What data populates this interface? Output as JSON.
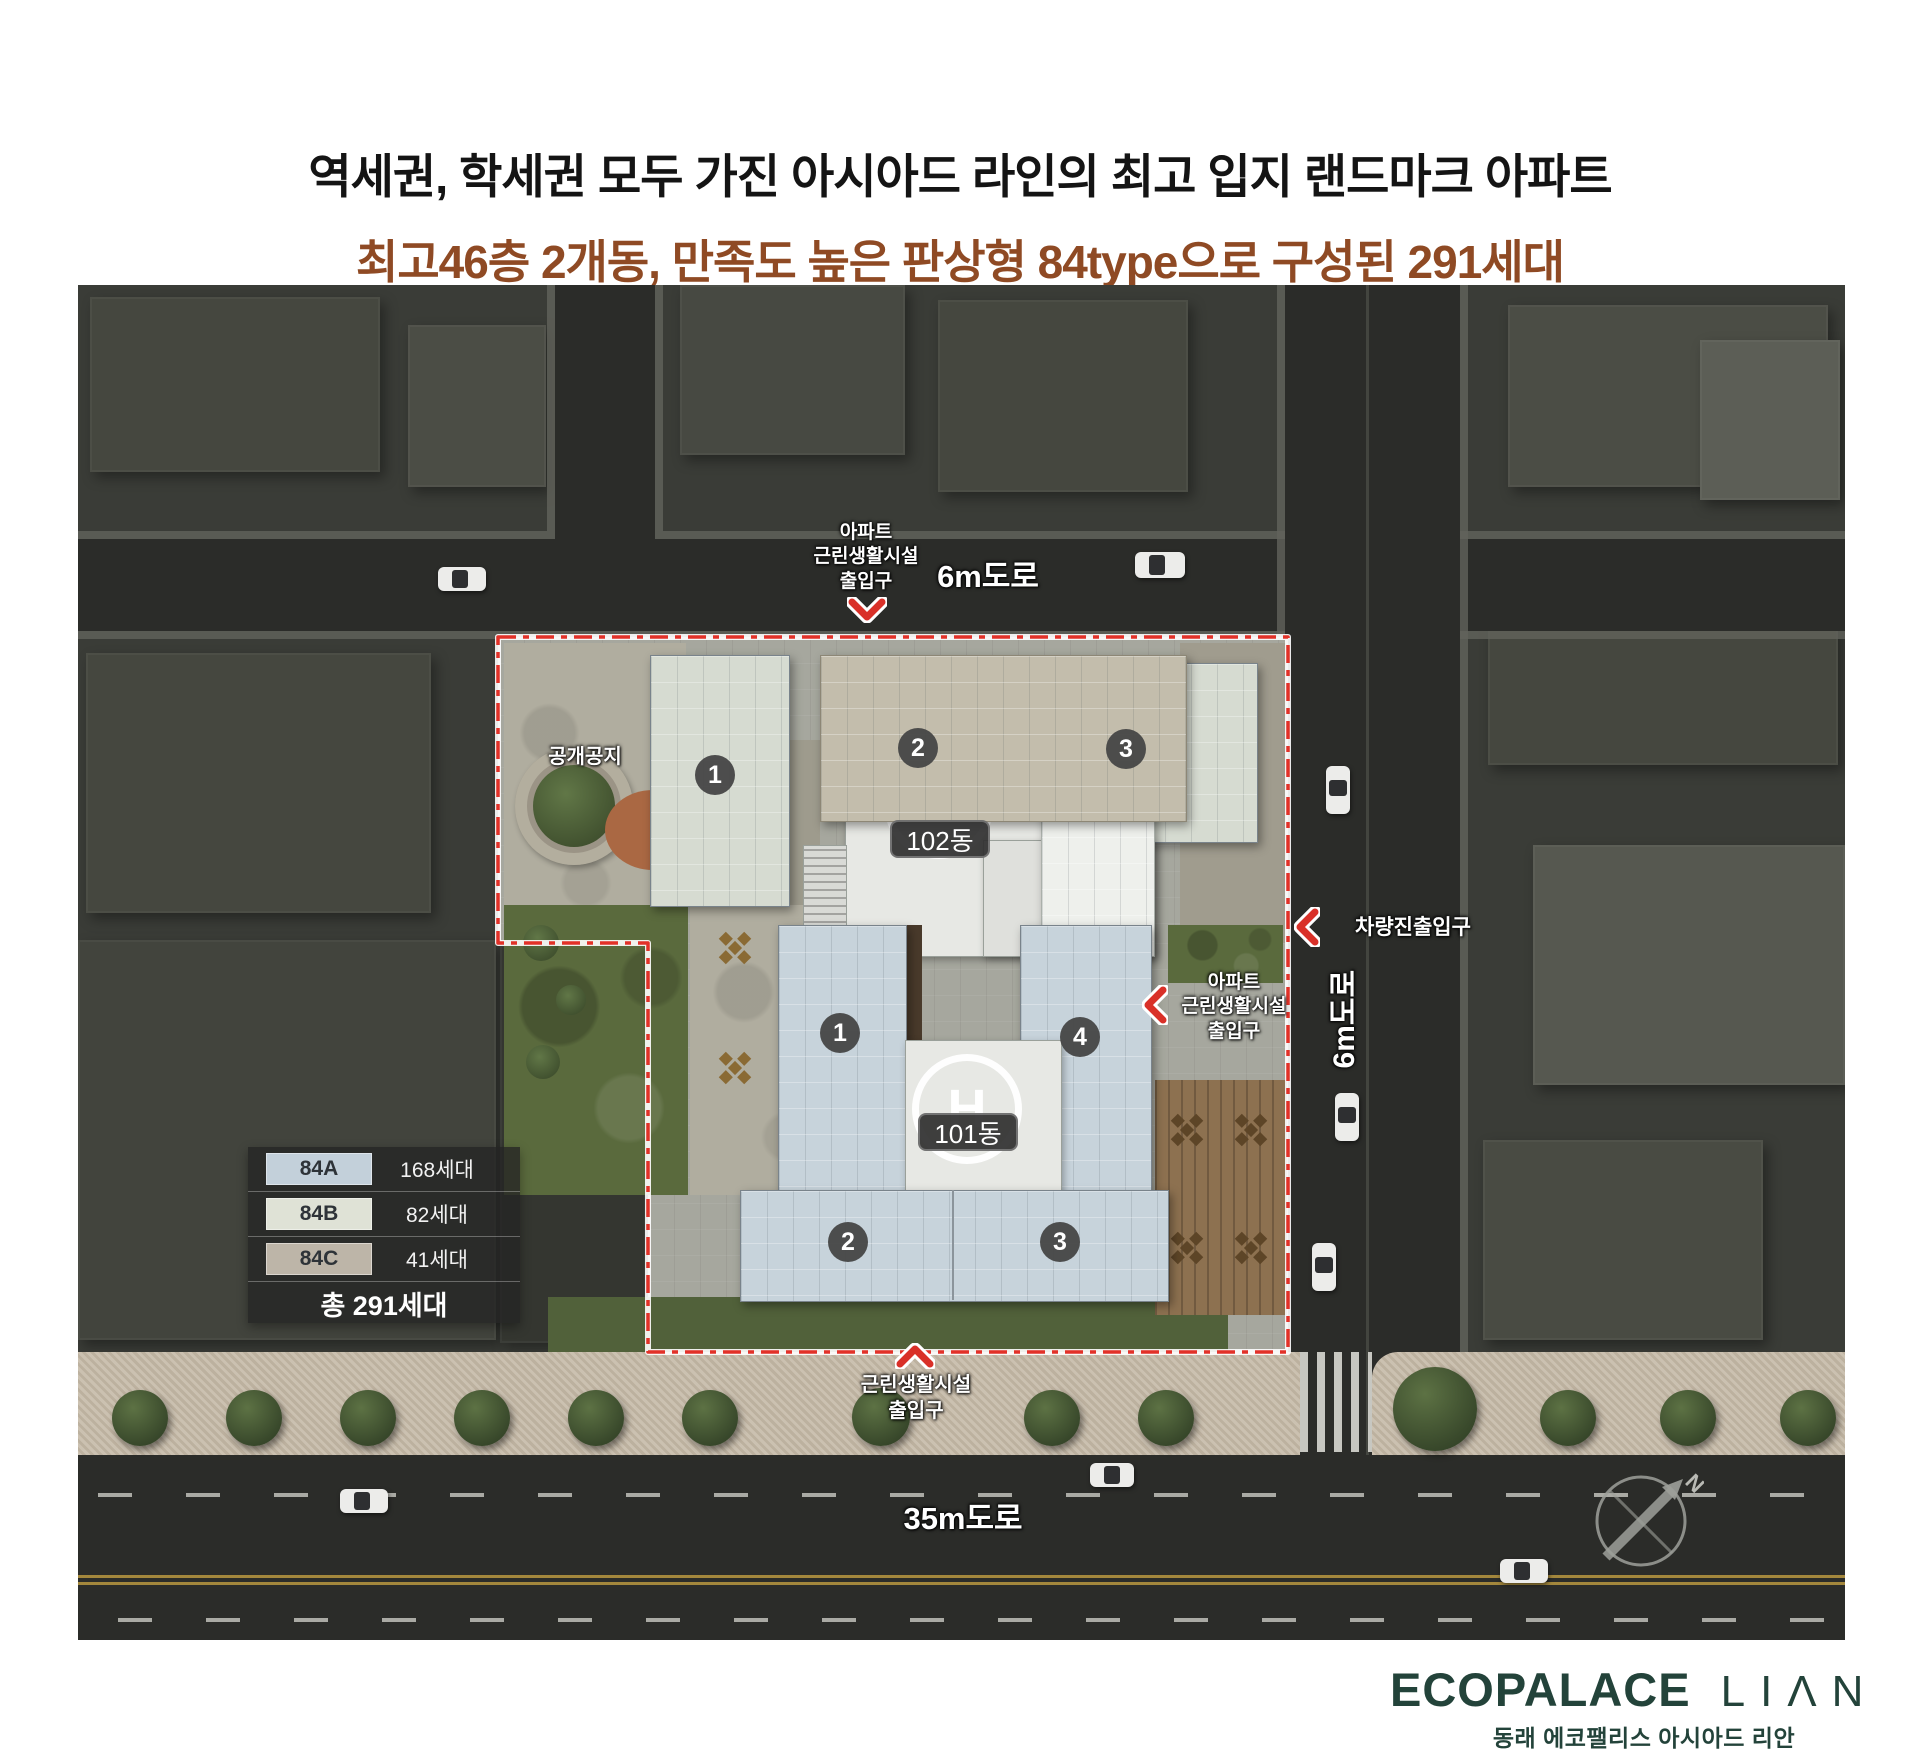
{
  "title": {
    "line1": "역세권, 학세권 모두 가진 아시아드 라인의 최고 입지 랜드마크 아파트",
    "line2": "최고46층 2개동, 만족도 높은 판상형 84type으로 구성된 291세대",
    "line2_color": "#8f4a24"
  },
  "plan": {
    "open_space": "공개공지",
    "roads": {
      "top": "6m도로",
      "right": "6m도로",
      "bottom": "35m도로"
    },
    "labels": {
      "apt_entrance_top": {
        "l1": "아파트",
        "l2": "근린생활시설",
        "l3": "출입구"
      },
      "vehicle_entrance": "차량진출입구",
      "apt_entrance_right": {
        "l1": "아파트",
        "l2": "근린생활시설",
        "l3": "출입구"
      },
      "retail_entrance_bottom": {
        "l1": "근린생활시설",
        "l2": "출입구"
      }
    },
    "buildings": {
      "b102": {
        "name": "102동",
        "helipad": "H",
        "units": [
          "1",
          "2",
          "3"
        ]
      },
      "b101": {
        "name": "101동",
        "helipad": "H",
        "units": [
          "1",
          "4",
          "2",
          "3"
        ]
      }
    },
    "compass": {
      "north": "N"
    },
    "boundary_color": "#e23128"
  },
  "legend": {
    "rows": [
      {
        "type": "84A",
        "count": "168세대",
        "color": "#c3d0da"
      },
      {
        "type": "84B",
        "count": "82세대",
        "color": "#dfe2d6"
      },
      {
        "type": "84C",
        "count": "41세대",
        "color": "#bdb5a8"
      }
    ],
    "total": "총 291세대"
  },
  "footer": {
    "brand_main": "ECOPALACE",
    "brand_sub": "LIΛN",
    "tagline": "동래 에코팰리스 아시아드 리안",
    "brand_color": "#23433a"
  }
}
